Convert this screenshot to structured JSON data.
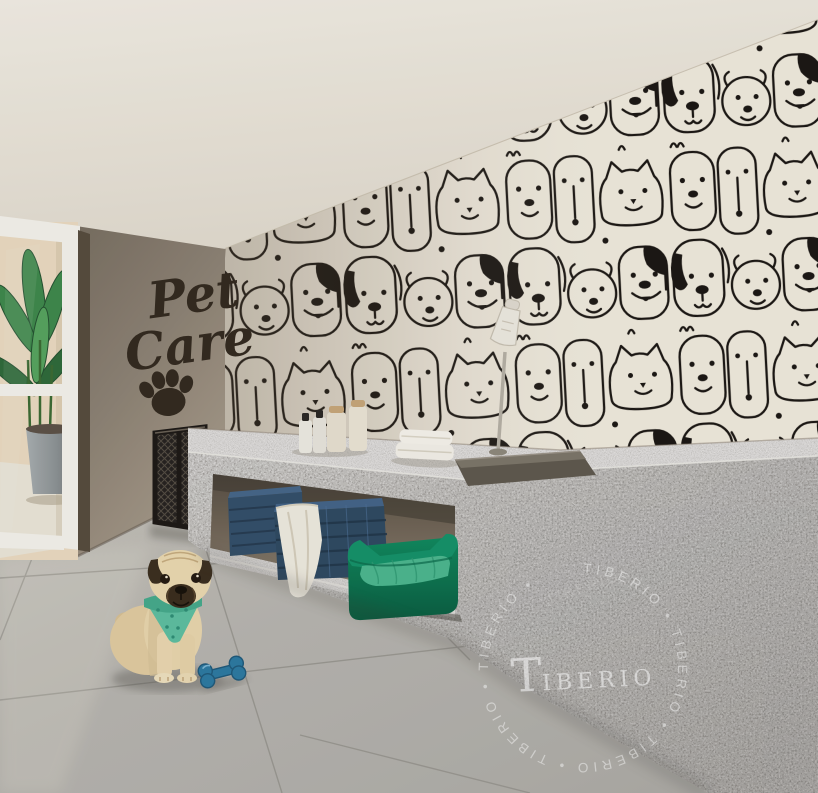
{
  "meta": {
    "title": "Pet Care room — architectural interior rendering"
  },
  "sign": {
    "line1": "Pet",
    "line2": "Care",
    "symbol": "paw-print",
    "color": "#332a1f"
  },
  "watermark": {
    "brand": "TIBERIO",
    "brand_initial": "T",
    "brand_rest": "IBERIO",
    "ring_text": "TIBERIO • TIBERIO • TIBERIO • TIBERIO • TIBERIO • ",
    "ghost_text": "TIBERIO",
    "color": "#ffffff"
  },
  "scene": {
    "wallpaper": "black-and-white doodle crowd of dog and cat faces",
    "objects": [
      {
        "name": "pug-dog",
        "desc": "fawn pug wearing a teal bandana sitting on the tile floor"
      },
      {
        "name": "bone-toy",
        "desc": "blue rubber bone toy",
        "color": "#2d7ba3"
      },
      {
        "name": "pet-bed",
        "desc": "emerald green pet bed under the counter",
        "color": "#117a55"
      },
      {
        "name": "storage-baskets",
        "desc": "two navy woven baskets with a white towel draped",
        "color": "#33506b"
      },
      {
        "name": "grooming-counter",
        "desc": "speckled grey granite grooming counter with sink and hand shower"
      },
      {
        "name": "counter-towels",
        "desc": "folded white towels on the countertop"
      },
      {
        "name": "amenity-bottles",
        "desc": "pet shampoo bottles and jars on the countertop"
      },
      {
        "name": "mesh-gate",
        "desc": "dark metal mesh pet gate at the counter end"
      },
      {
        "name": "glass-door",
        "desc": "white framed glass door with potted plant beyond"
      },
      {
        "name": "accent-wall",
        "desc": "taupe wall with Pet Care lettering and paw print"
      }
    ],
    "palette": {
      "ceiling": "#f1ece2",
      "wall_taupe": "#8e8375",
      "wallpaper_bg": "#f2ecdf",
      "doodle_ink": "#1b1713",
      "granite": "#d3d0ca",
      "floor": "#b2b0ab",
      "accent_green": "#117a55",
      "bandana_teal": "#5ec0a2",
      "basket_navy": "#33506b"
    }
  }
}
